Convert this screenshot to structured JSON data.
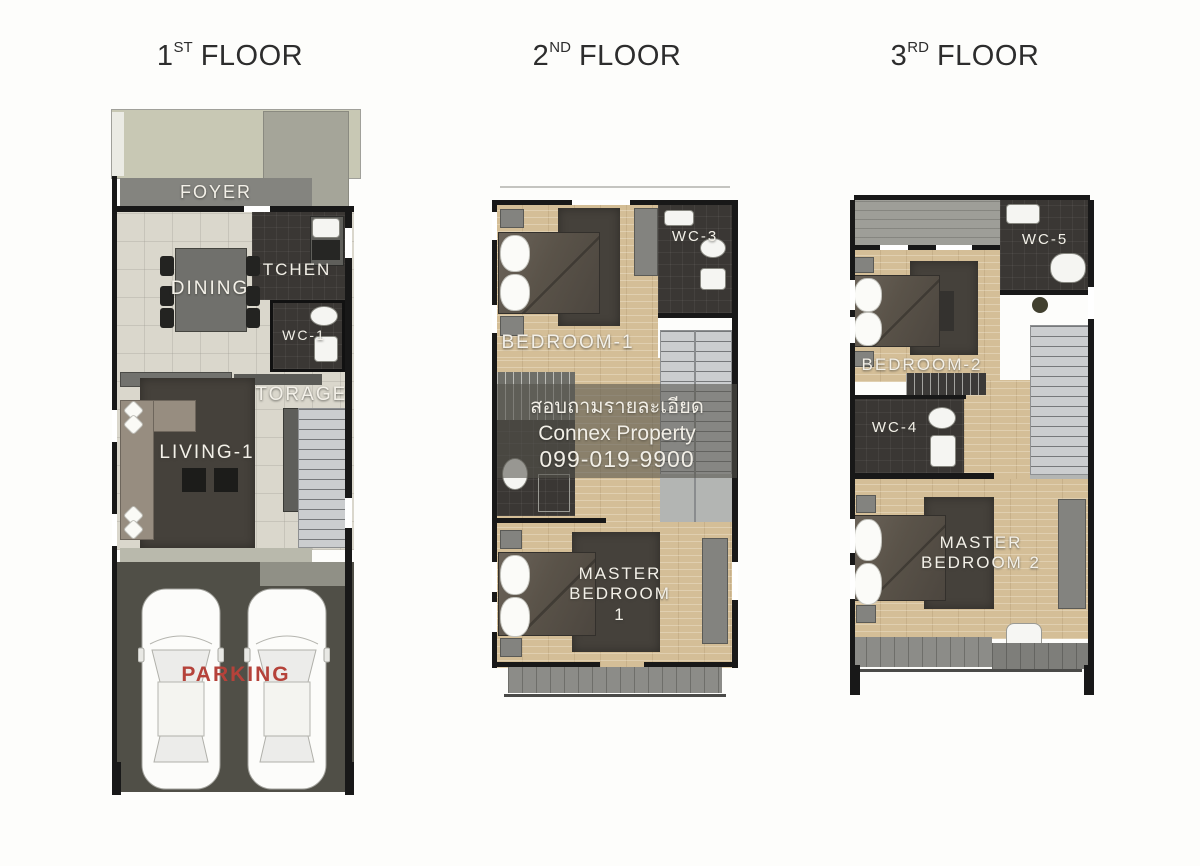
{
  "colors": {
    "wall": "#181818",
    "wood": "#d4be97",
    "dark": "#3a3734",
    "rug": "#45413b",
    "gray": "#8c8c88",
    "tile": "#dad7cc",
    "yard": "#c8c8b4",
    "asphalt": "#504f47",
    "stair": "#cbcdcf",
    "label": "#f3f0e8",
    "red": "#b5423a",
    "bed": "#564f47",
    "sofa": "#978d80",
    "furn": "#83837f",
    "landing": "#b3b5b3",
    "title": "#2d2d2d"
  },
  "titles": {
    "floor1": {
      "number": "1",
      "ordinal": "ST",
      "word": "FLOOR"
    },
    "floor2": {
      "number": "2",
      "ordinal": "ND",
      "word": "FLOOR"
    },
    "floor3": {
      "number": "3",
      "ordinal": "RD",
      "word": "FLOOR"
    }
  },
  "floor1": {
    "labels": {
      "foyer": "FOYER",
      "dining": "DINING",
      "kitchen": "KITCHEN",
      "wc1": "WC-1",
      "storage": "STORAGE",
      "living": "LIVING-1",
      "parking": "PARKING"
    }
  },
  "floor2": {
    "labels": {
      "bedroom1": "BEDROOM-1",
      "wc3": "WC-3",
      "master1": "MASTER BEDROOM 1"
    }
  },
  "floor3": {
    "labels": {
      "bedroom2": "BEDROOM-2",
      "wc5": "WC-5",
      "wc4": "WC-4",
      "master2": "MASTER BEDROOM 2"
    }
  },
  "watermark": {
    "line1": "สอบถามรายละเอียด",
    "line2": "Connex Property",
    "line3": "099-019-9900"
  }
}
